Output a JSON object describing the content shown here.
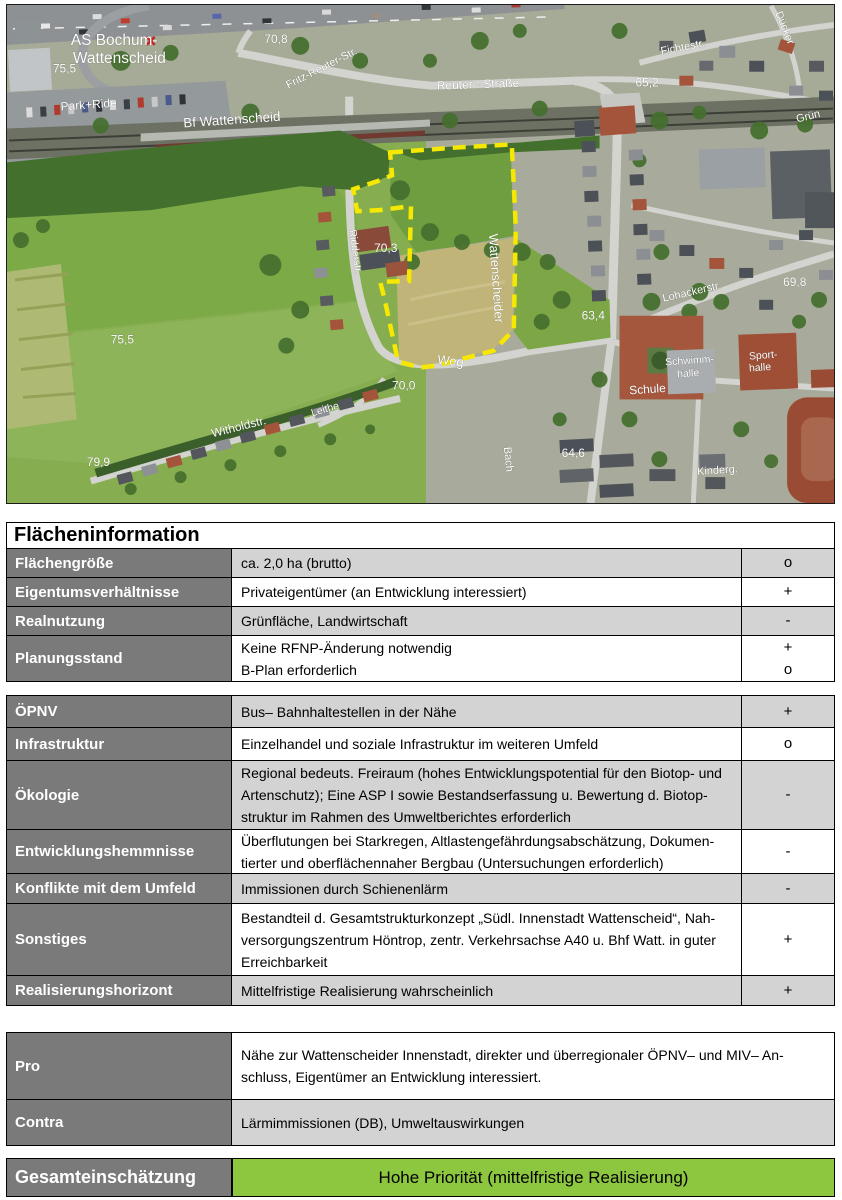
{
  "info_table": {
    "title": "Flächeninformation",
    "block1_rows": [
      {
        "label": "Flächengröße",
        "value": "ca. 2,0 ha (brutto)",
        "rating": "o"
      },
      {
        "label": "Eigentumsverhältnisse",
        "value": "Privateigentümer (an Entwicklung interessiert)",
        "rating": "+"
      },
      {
        "label": "Realnutzung",
        "value": "Grünfläche, Landwirtschaft",
        "rating": "-"
      },
      {
        "label": "Planungsstand",
        "value": [
          "Keine RFNP-Änderung notwendig",
          "B-Plan erforderlich"
        ],
        "rating": [
          "+",
          "o"
        ]
      }
    ],
    "block2_rows": [
      {
        "label": "ÖPNV",
        "value": "Bus– Bahnhaltestellen in der Nähe",
        "rating": "+"
      },
      {
        "label": "Infrastruktur",
        "value": "Einzelhandel und soziale Infrastruktur im weiteren Umfeld",
        "rating": "o"
      },
      {
        "label": "Ökologie",
        "value": [
          "Regional bedeuts. Freiraum (hohes Entwicklungspotential für den Biotop- und",
          "Artenschutz); Eine ASP I sowie Bestandserfassung u. Bewertung d. Biotop-",
          "struktur im Rahmen des Umweltberichtes erforderlich"
        ],
        "rating": "-"
      },
      {
        "label": "Entwicklungshemmnisse",
        "value": [
          "Überflutungen bei Starkregen, Altlastengefährdungsabschätzung, Dokumen-",
          "tierter und oberflächennaher Bergbau (Untersuchungen erforderlich)"
        ],
        "rating": "-"
      },
      {
        "label": "Konflikte mit dem Umfeld",
        "value": "Immissionen durch Schienenlärm",
        "rating": "-"
      },
      {
        "label": "Sonstiges",
        "value": [
          "Bestandteil d. Gesamtstrukturkonzept „Südl. Innenstadt Wattenscheid“, Nah-",
          "versorgungszentrum Höntrop, zentr. Verkehrsachse A40 u. Bhf Watt. in guter",
          "Erreichbarkeit"
        ],
        "rating": "+"
      },
      {
        "label": "Realisierungshorizont",
        "value": "Mittelfristige Realisierung wahrscheinlich",
        "rating": "+"
      }
    ]
  },
  "assessment": {
    "pro_label": "Pro",
    "pro_text": [
      "Nähe zur Wattenscheider Innenstadt, direkter und überregionaler ÖPNV– und MIV– An-",
      "schluss, Eigentümer an Entwicklung interessiert."
    ],
    "contra_label": "Contra",
    "contra_text": "Lärmimmissionen (DB), Umweltauswirkungen",
    "overall_label": "Gesamteinschätzung",
    "overall_value": "Hohe Priorität (mittelfristige Realisierung)",
    "overall_color": "#8dc63f"
  },
  "photo": {
    "boundary_color": "#f6e800",
    "labels": {
      "as1": "AS Bochum-",
      "as2": "Wattenscheid",
      "h755a": "75,5",
      "h708": "70,8",
      "park_ride": "Park+Ride",
      "bf": "Bf Wattenscheid",
      "frs1": "Fritz-Reuter-Str.",
      "frs2": "Reuter - Straße",
      "h652": "65,2",
      "fichte": "Fichtestr.",
      "duecker": "Dücker",
      "gruen": "Grün",
      "h703": "70,3",
      "wattenscheider": "Wattenscheider",
      "weg": "Weg",
      "ridder": "Ridderstr.",
      "h755b": "75,5",
      "h799": "79,9",
      "withold": "Witholdstr.",
      "leithe": "Leithe",
      "h700": "70,0",
      "h634": "63,4",
      "lohacker": "Lohackerstr.",
      "h698": "69,8",
      "schule": "Schule",
      "schwimm1": "Schwimm-",
      "schwimm2": "halle",
      "sport1": "Sport-",
      "sport2": "halle",
      "h646": "64,6",
      "kinderg": "Kinderg.",
      "bach": "Bach"
    }
  }
}
